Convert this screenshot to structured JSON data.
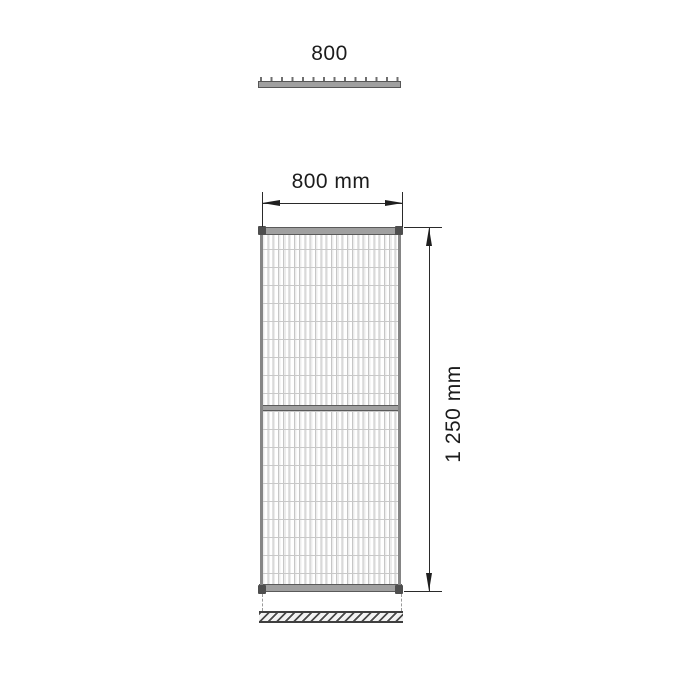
{
  "drawing": {
    "top_view": {
      "width_label": "800"
    },
    "front_view": {
      "width_dimension": {
        "label": "800 mm"
      },
      "height_dimension": {
        "label": "1 250 mm"
      }
    },
    "colors": {
      "background": "#ffffff",
      "frame_fill": "#a0a0a0",
      "frame_edge": "#565656",
      "corner_cap": "#4e4e4e",
      "mesh_line": "#c6c6c6",
      "dimension_line": "#2a2a2a",
      "hatch_line": "#4a4a4a"
    }
  }
}
